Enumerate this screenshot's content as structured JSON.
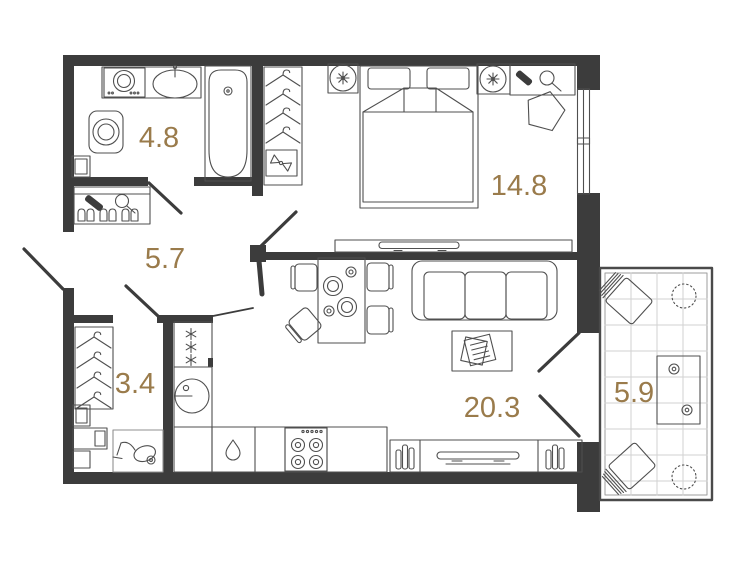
{
  "plan": {
    "title": "apartment-floor-plan",
    "rooms": [
      {
        "name": "bathroom",
        "area": "4.8"
      },
      {
        "name": "hallway",
        "area": "5.7"
      },
      {
        "name": "bedroom",
        "area": "14.8"
      },
      {
        "name": "wardrobe-closet",
        "area": "3.4"
      },
      {
        "name": "kitchen-living-room",
        "area": "20.3"
      },
      {
        "name": "balcony",
        "area": "5.9"
      }
    ],
    "icons": {
      "bathroom": [
        "washing-machine-icon",
        "sink-icon",
        "bathtub-icon",
        "toilet-icon"
      ],
      "hallway": [
        "shoe-rack-icon",
        "mirror-icon",
        "brush-icon"
      ],
      "bedroom": [
        "hanger-icon",
        "gift-box-icon",
        "bed-icon",
        "lamp-icon",
        "dressing-table-icon",
        "pouf-icon",
        "tv-icon"
      ],
      "wardrobe-closet": [
        "hanger-icon",
        "boxes-icon",
        "vacuum-icon"
      ],
      "kitchen-living-room": [
        "fridge-icon",
        "round-sink-icon",
        "drop-icon",
        "stove-icon",
        "dining-table-icon",
        "chair-icon",
        "sofa-icon",
        "coffee-table-icon",
        "tv-stand-icon",
        "books-icon"
      ],
      "balcony": [
        "garden-chair-icon",
        "plant-icon",
        "garden-table-icon"
      ]
    },
    "colors": {
      "wall": "#3c3c3c",
      "furniture_line": "#4f4f4f",
      "area_label": "#9a7b4b",
      "tile_grid": "#d2d2d2",
      "background": "#ffffff"
    }
  }
}
